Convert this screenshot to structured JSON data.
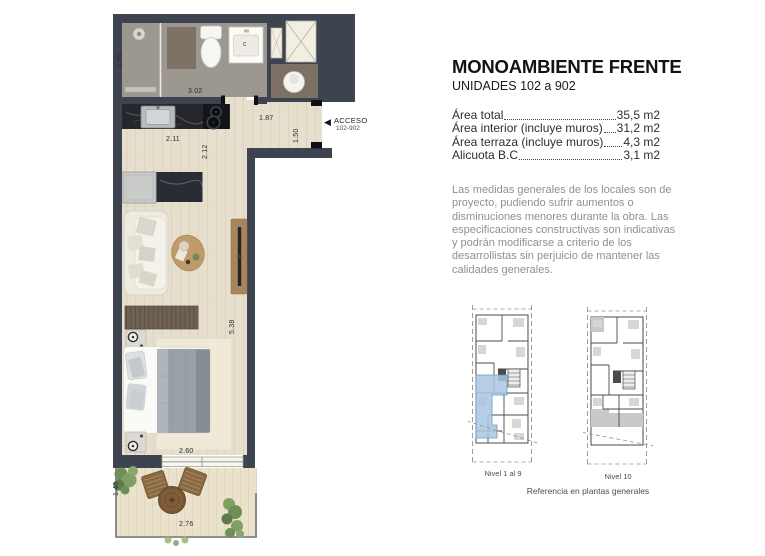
{
  "panel": {
    "title": "MONOAMBIENTE FRENTE",
    "subtitle": "UNIDADES 102 a 902",
    "areas": [
      {
        "label": "Área total",
        "value": "35,5 m2"
      },
      {
        "label": "Área interior (incluye muros)",
        "value": "31,2 m2"
      },
      {
        "label": "Área terraza (incluye muros)",
        "value": "4,3 m2"
      },
      {
        "label": "Alicuota B.C",
        "value": "3,1 m2"
      }
    ],
    "disclaimer": "Las medidas generales de los locales son de proyecto, pudiendo sufrir aumentos o disminuciones menores durante la obra. Las especificaciones constructivas son indicativas y podrán modificarse a criterio de los desarrollistas sin perjuicio de mantener las calidades generales.",
    "thumbnails": [
      {
        "label": "Nivel 1 al 9"
      },
      {
        "label": "Nivel 10"
      }
    ],
    "reference_caption": "Referencia en plantas generales"
  },
  "floorplan": {
    "access": {
      "arrow": "◀",
      "label": "ACCESO",
      "units": "102-902"
    },
    "fixtures": {
      "vanity_label": "c"
    },
    "dimensions": {
      "shower_width": "1.50",
      "bathroom_width": "3.02",
      "kitchen_width": "2.11",
      "kitchen_depth": "2.12",
      "entry_width": "1.87",
      "entry_depth": "1.50",
      "living_length": "5.38",
      "window_width": "2.60",
      "terrace_depth": "1.40",
      "terrace_width": "2.76"
    },
    "colors": {
      "wall": "#3e4350",
      "wood_floor": "#e7dfcd",
      "bathroom_floor": "#9c9890",
      "terrace_floor": "#eae2cb",
      "unit_highlight": "#a9c7e2"
    }
  }
}
